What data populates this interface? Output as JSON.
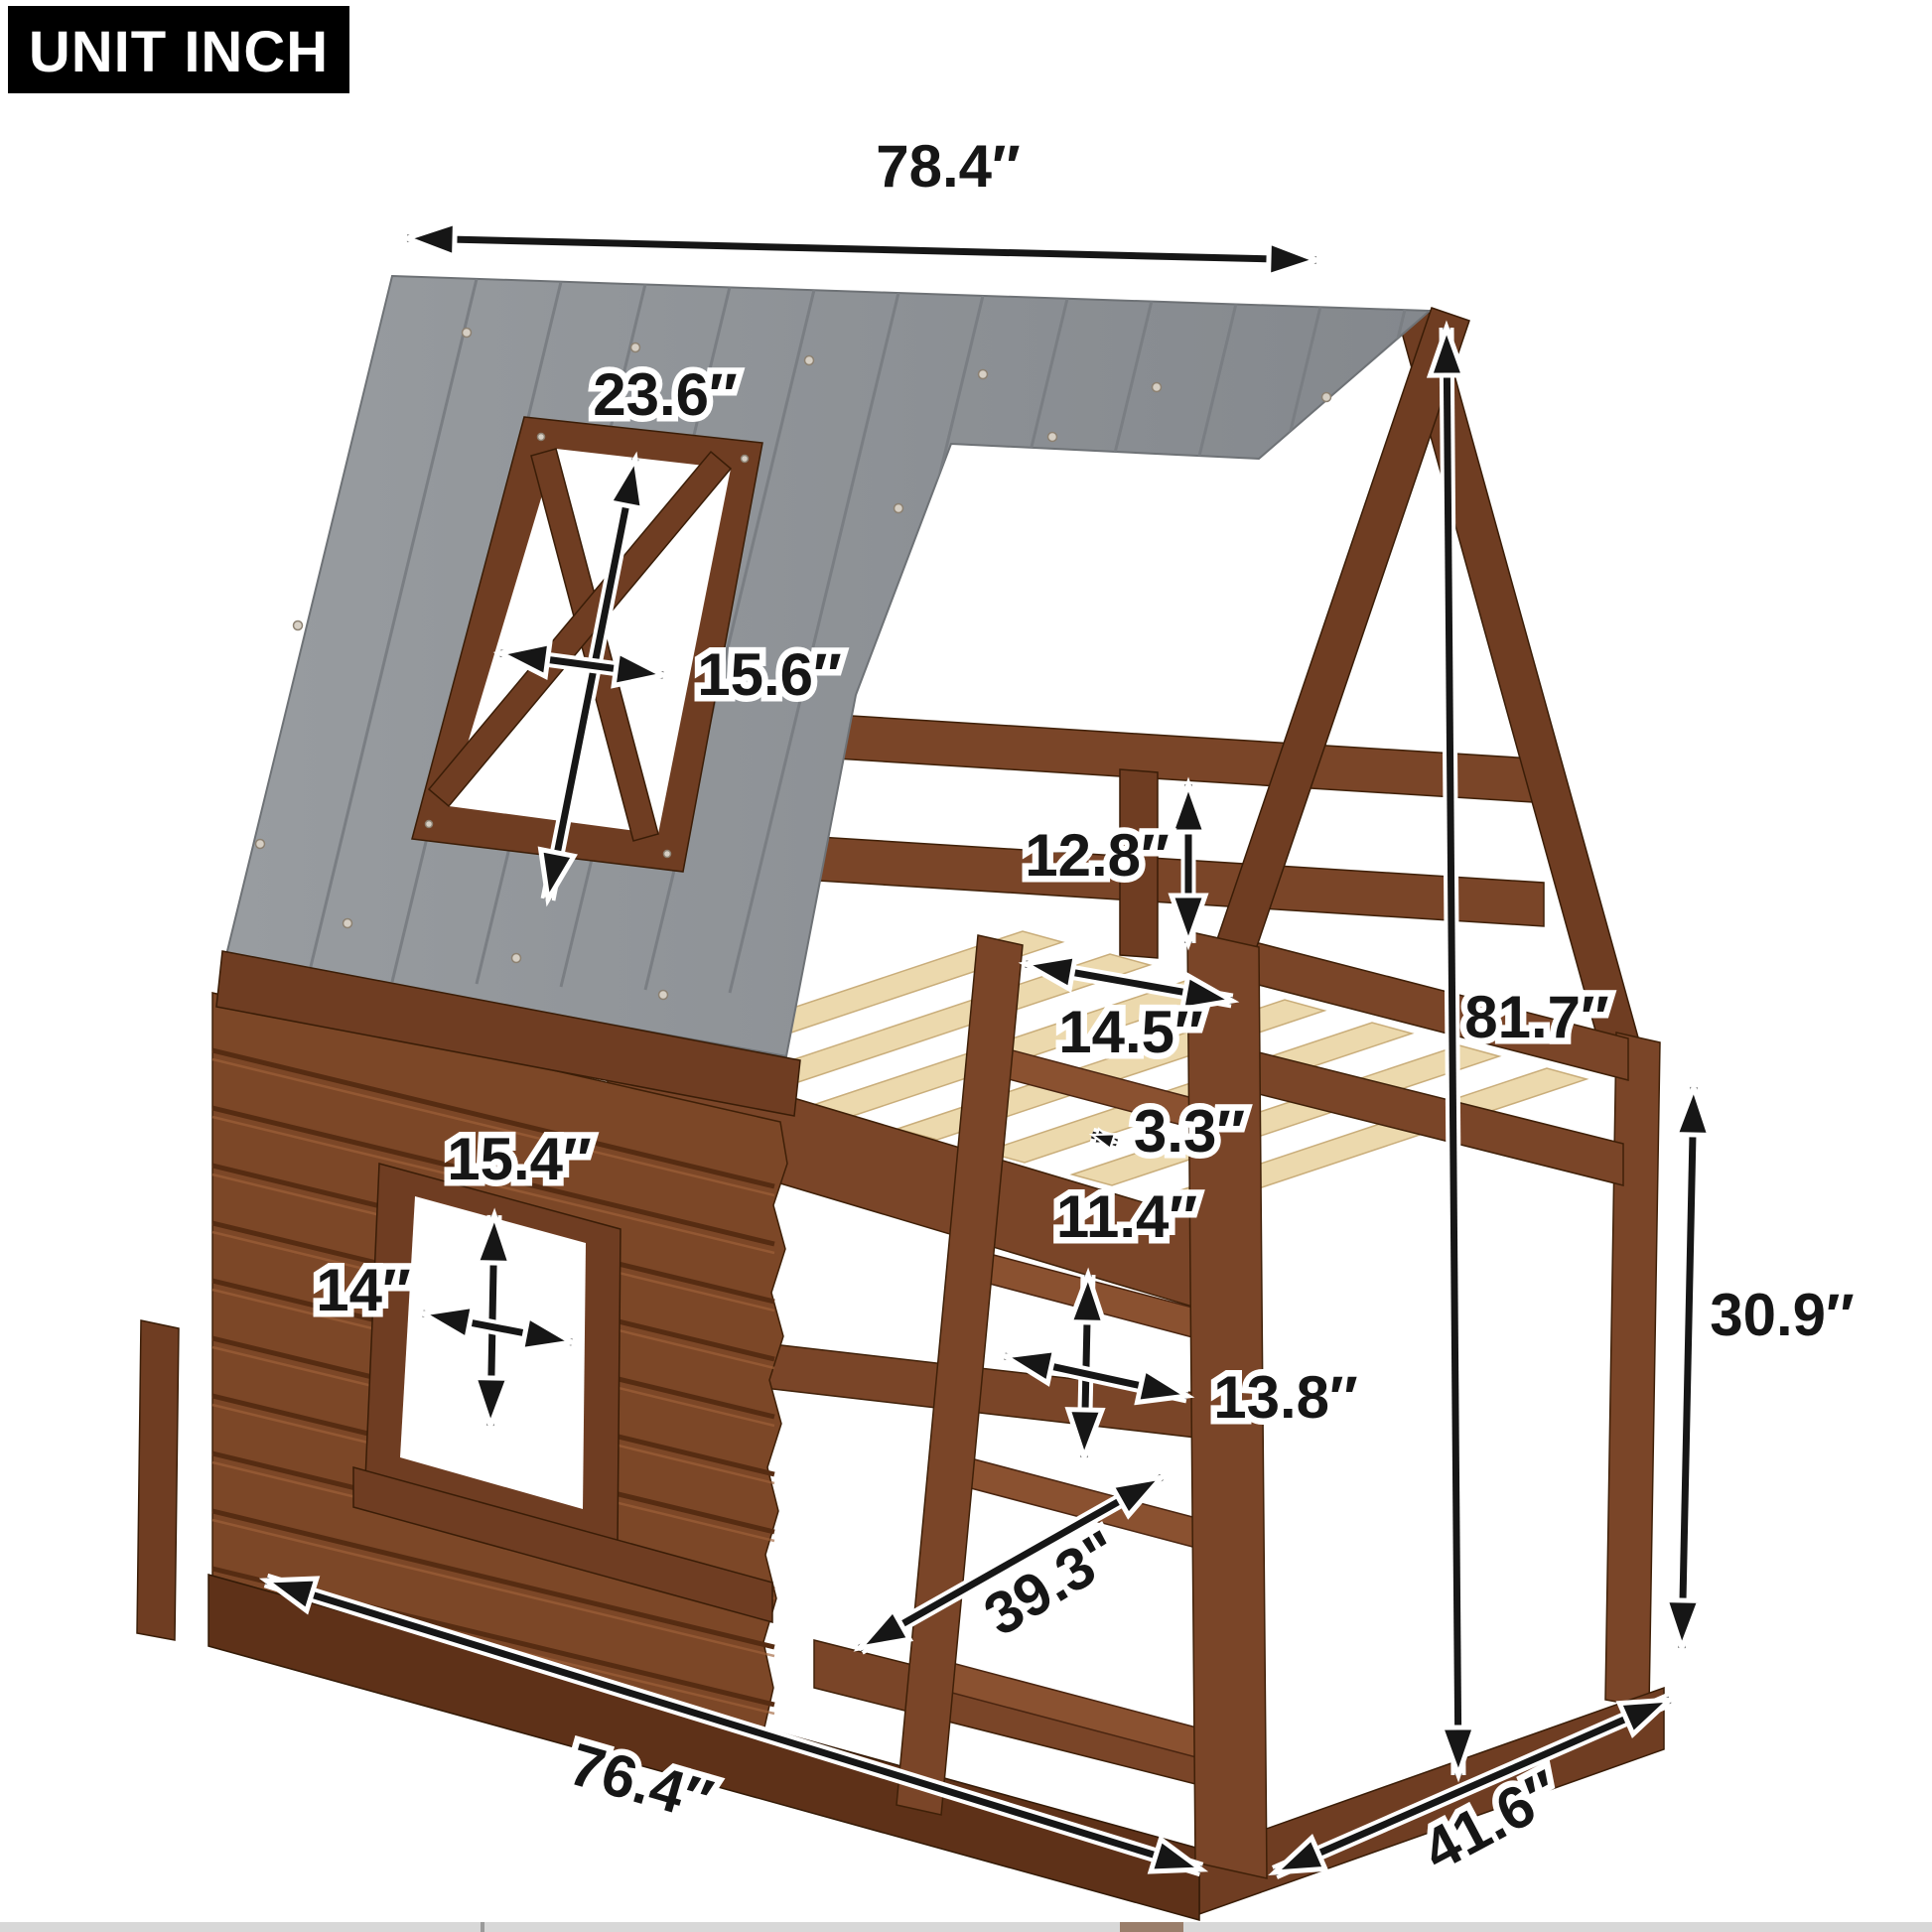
{
  "badge": {
    "label": "UNIT INCH"
  },
  "labels": {
    "top_width": "78.4″",
    "skylight_height": "23.6″",
    "skylight_width": "15.6″",
    "guardrail_height": "12.8″",
    "ladder_opening": "14.5″",
    "slat_width": "3.3″",
    "overall_height": "81.7″",
    "window_height": "15.4″",
    "window_width": "14″",
    "rung_spacing": "11.4″",
    "ladder_width": "13.8″",
    "clearance_height": "30.9″",
    "ladder_length": "39.3\"",
    "base_length": "76.4″",
    "base_depth": "41.6″"
  },
  "colors": {
    "roof": "#909499",
    "wood": "#7a4528",
    "wood_dark": "#5e3118",
    "slat": "#ecd9ad",
    "arrow": "#161616",
    "halo": "#ffffff",
    "badge_bg": "#000000",
    "badge_fg": "#ffffff",
    "strip": "#d8d8d8"
  }
}
